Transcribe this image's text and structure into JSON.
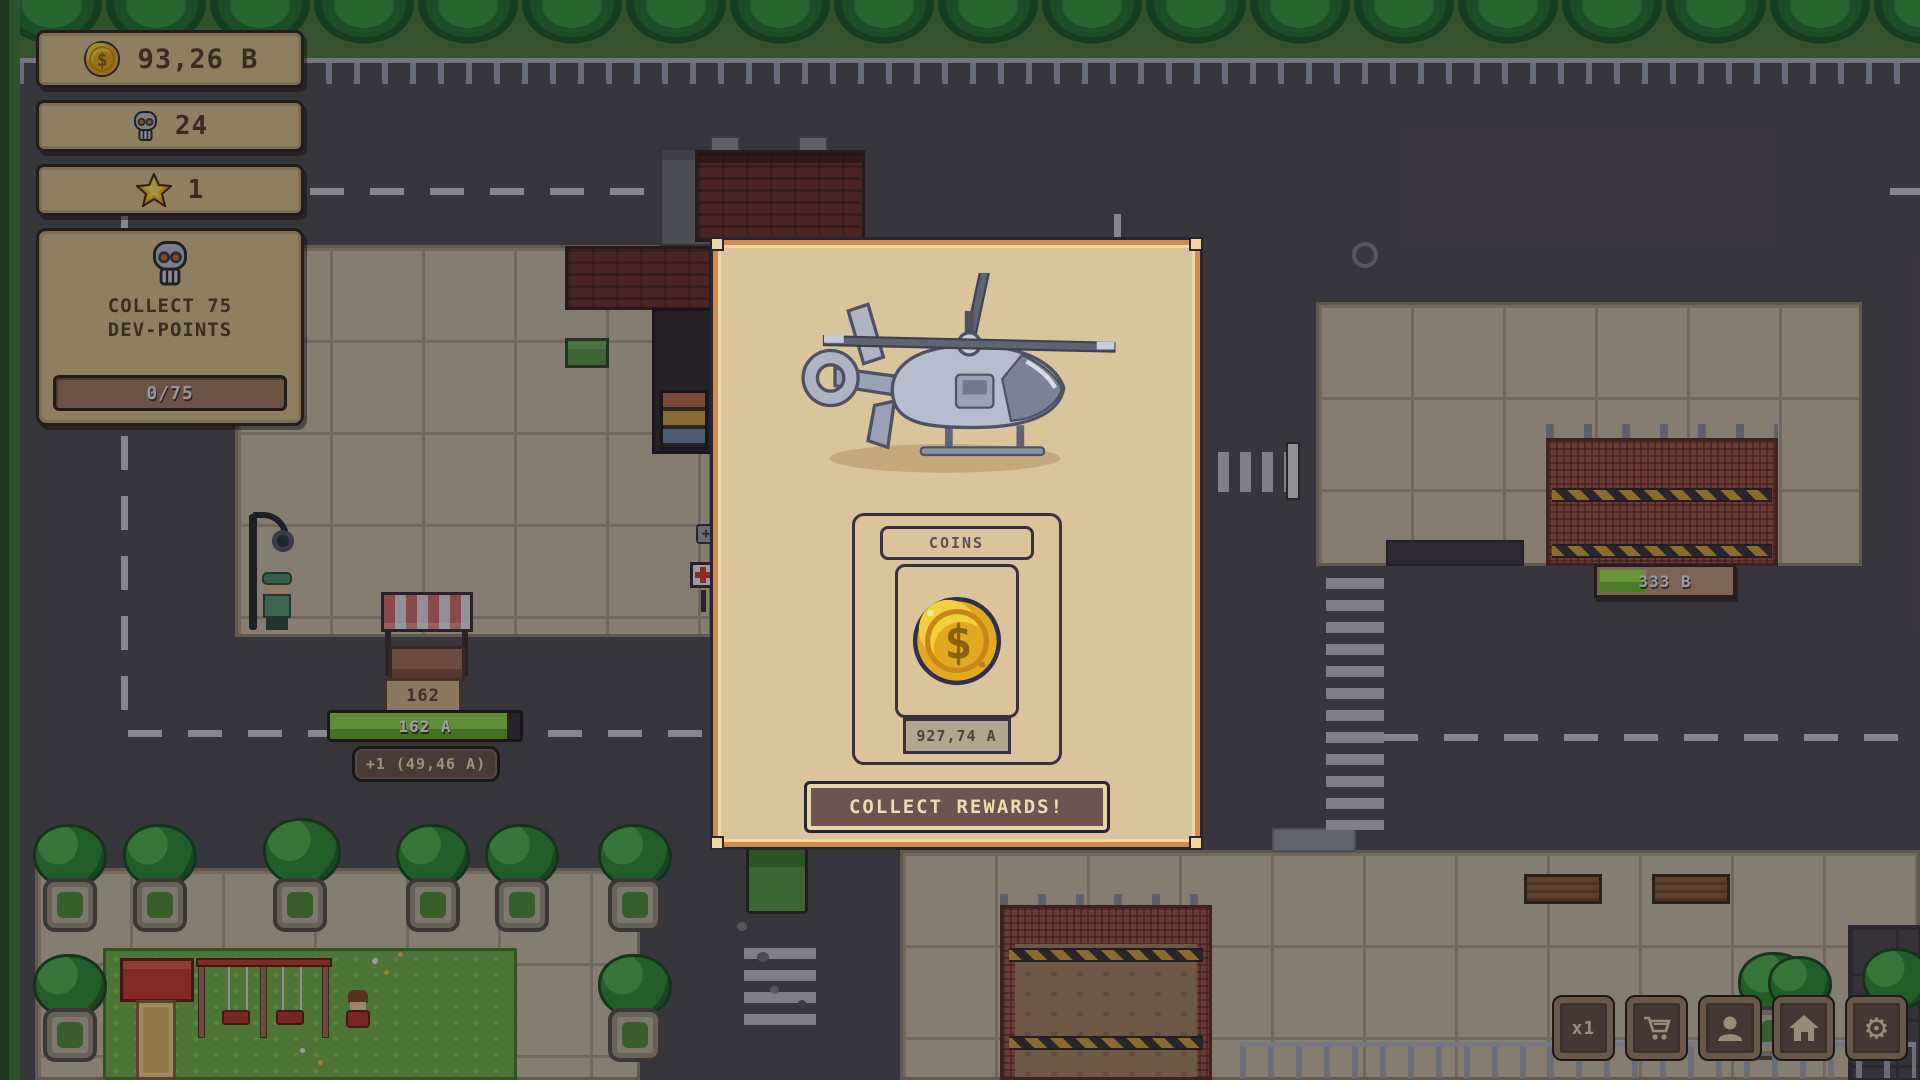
{
  "icons": {
    "dollar_glyph": "$",
    "gear_glyph": "⚙",
    "plus_glyph": "+"
  },
  "colors": {
    "modal_frame": "#d08a4c",
    "modal_bg": "#d9c49c",
    "modal_button_bg": "#6d5450",
    "panel_tan": "#d4bd8c",
    "gold": "#e2a81e",
    "progress_green": "#74c238",
    "asphalt": "#504e55",
    "pavement": "#c6b9a4"
  },
  "hud": {
    "coins": {
      "icon": "coin-icon",
      "value": "93,26 B"
    },
    "dev_points": {
      "icon": "skull-icon",
      "value": "24"
    },
    "stars": {
      "icon": "star-icon",
      "value": "1"
    },
    "quest": {
      "icon": "skull-icon",
      "title": "COLLECT 75\nDEV-POINTS",
      "progress": "0/75"
    }
  },
  "modal": {
    "illustration": "helicopter",
    "reward": {
      "label": "COINS",
      "icon": "coin-icon",
      "value": "927,74 A"
    },
    "collect_button": "COLLECT REWARDS!"
  },
  "world": {
    "stall_id": "162",
    "stall_progress": "162 A",
    "stall_rate": "+1 (49,46 A)",
    "warehouse_progress": "333 B"
  },
  "toolbar": {
    "multiplier": "x1"
  }
}
